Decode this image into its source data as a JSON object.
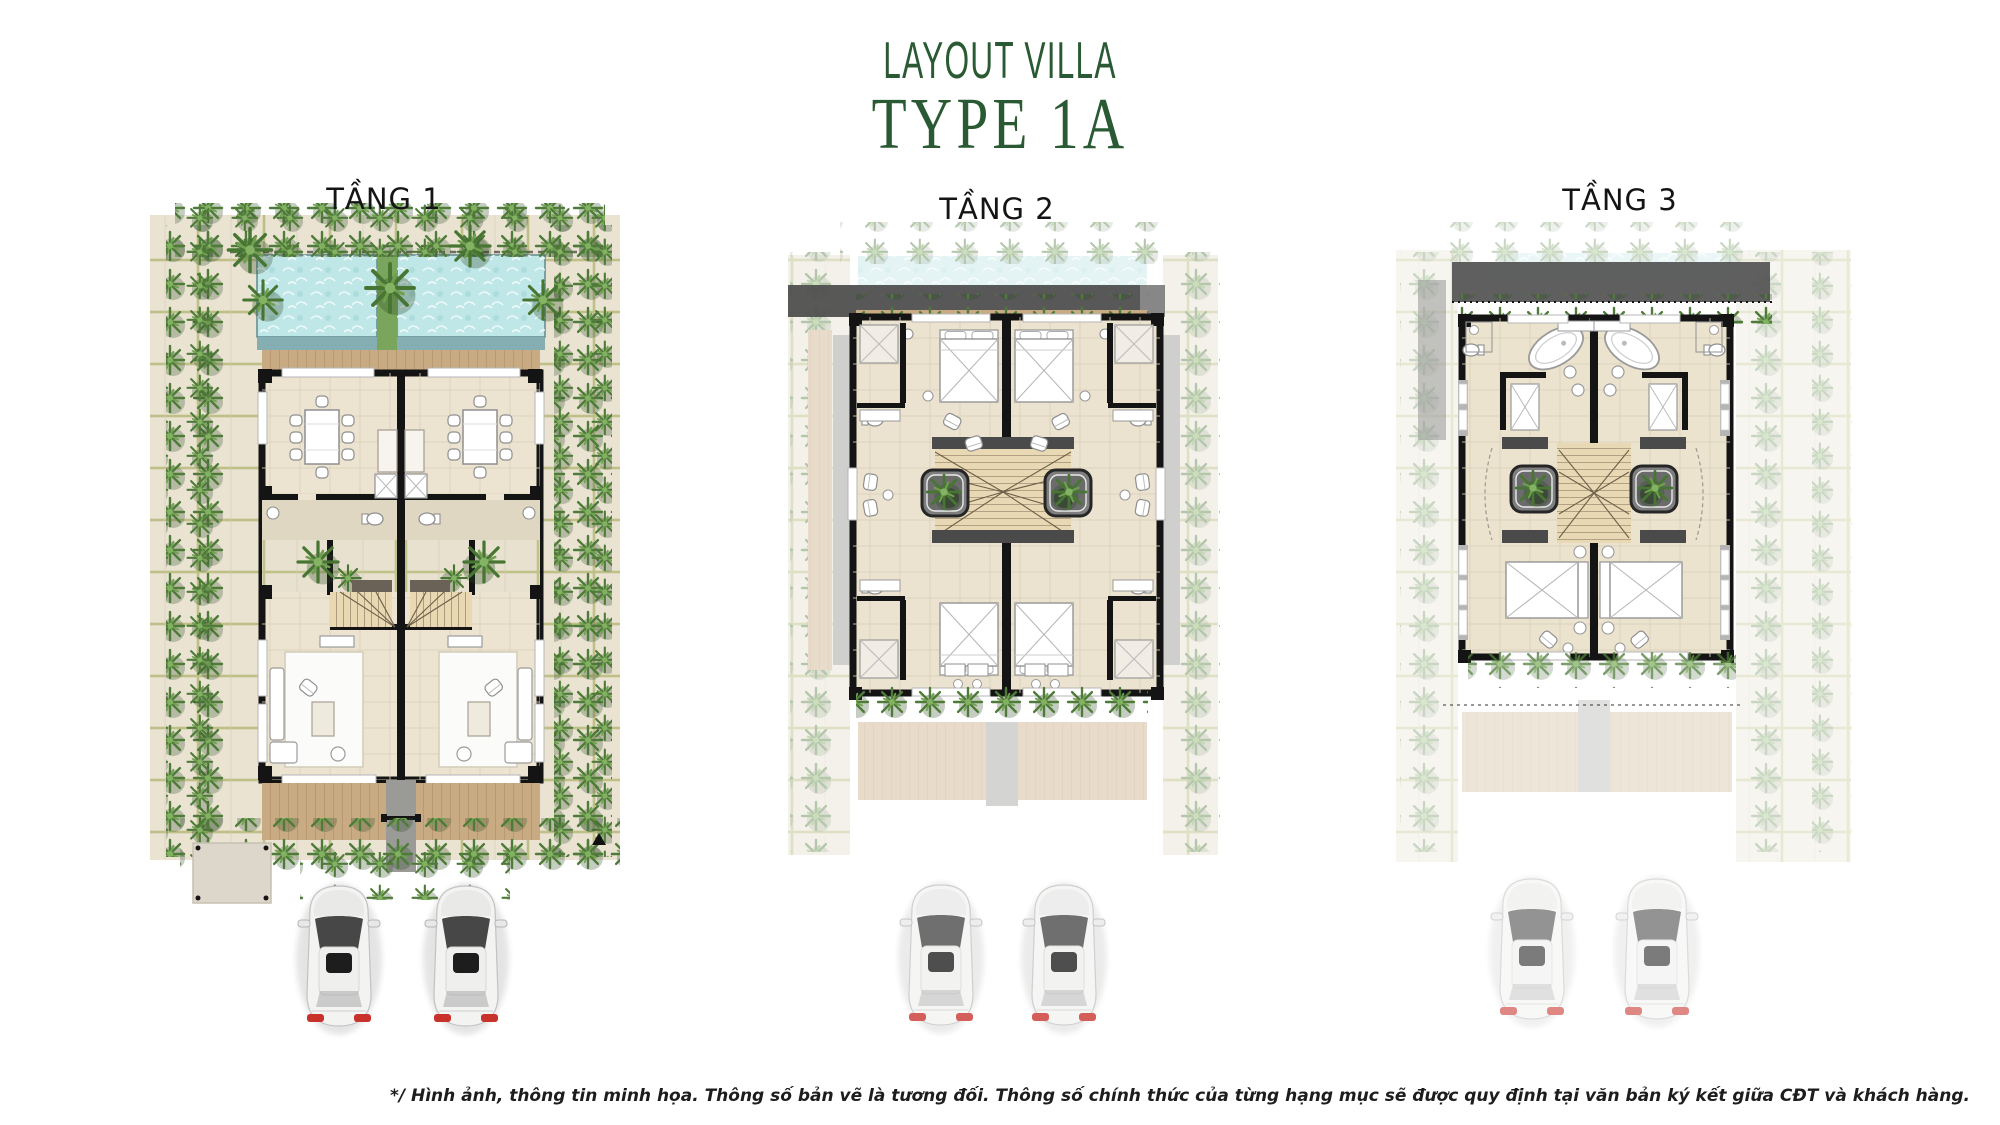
{
  "header": {
    "title": "LAYOUT VILLA",
    "subtitle": "TYPE 1A"
  },
  "plans": [
    {
      "id": "tang-1",
      "label": "TẦNG 1",
      "floor": 1,
      "elements": [
        "palm-garden-border",
        "twin-infinity-pools",
        "wood-deck",
        "dining-table-8-seats",
        "kitchen-counter",
        "bathroom-wc",
        "entry-court",
        "winder-staircase",
        "living-room-sofa",
        "rear-wood-deck",
        "two-parked-cars",
        "entry-arrow-marker"
      ]
    },
    {
      "id": "tang-2",
      "label": "TẦNG 2",
      "floor": 2,
      "elements": [
        "ghost-pool",
        "roof-band",
        "planter-foliage",
        "bedroom-bed",
        "ensuite-shower-wc",
        "lounge-chairs",
        "skylight-planter",
        "winder-staircase",
        "balcony-loungers",
        "two-parked-cars-faded"
      ]
    },
    {
      "id": "tang-3",
      "label": "TẦNG 3",
      "floor": 3,
      "elements": [
        "ghost-surroundings",
        "roof-band",
        "planter-foliage",
        "master-bathtub",
        "twin-basins",
        "wardrobe-closet",
        "skylight-planter",
        "winder-staircase",
        "master-bed",
        "lounge-chair",
        "two-parked-cars-faded"
      ]
    }
  ],
  "footer": {
    "disclaimer": "*/ Hình ảnh, thông tin minh họa. Thông số bản vẽ là tương đối. Thông số chính thức của từng hạng mục sẽ được quy định tại văn bản ký kết giữa CĐT và khách hàng."
  },
  "colors": {
    "title_green": "#2a5a33",
    "pool_water": "#bfe7e7",
    "pool_edge": "#84aeb2",
    "wall_black": "#141414",
    "floor_tile": "#ece4d1",
    "wood_deck": "#c9ab83",
    "paving": "#eae3d2",
    "paving_joint": "#a9b164",
    "foliage": "#4e7c38",
    "roof_gray": "#4f4f4f",
    "car_body": "#f3f3f2",
    "car_taillight": "#c9312b"
  }
}
